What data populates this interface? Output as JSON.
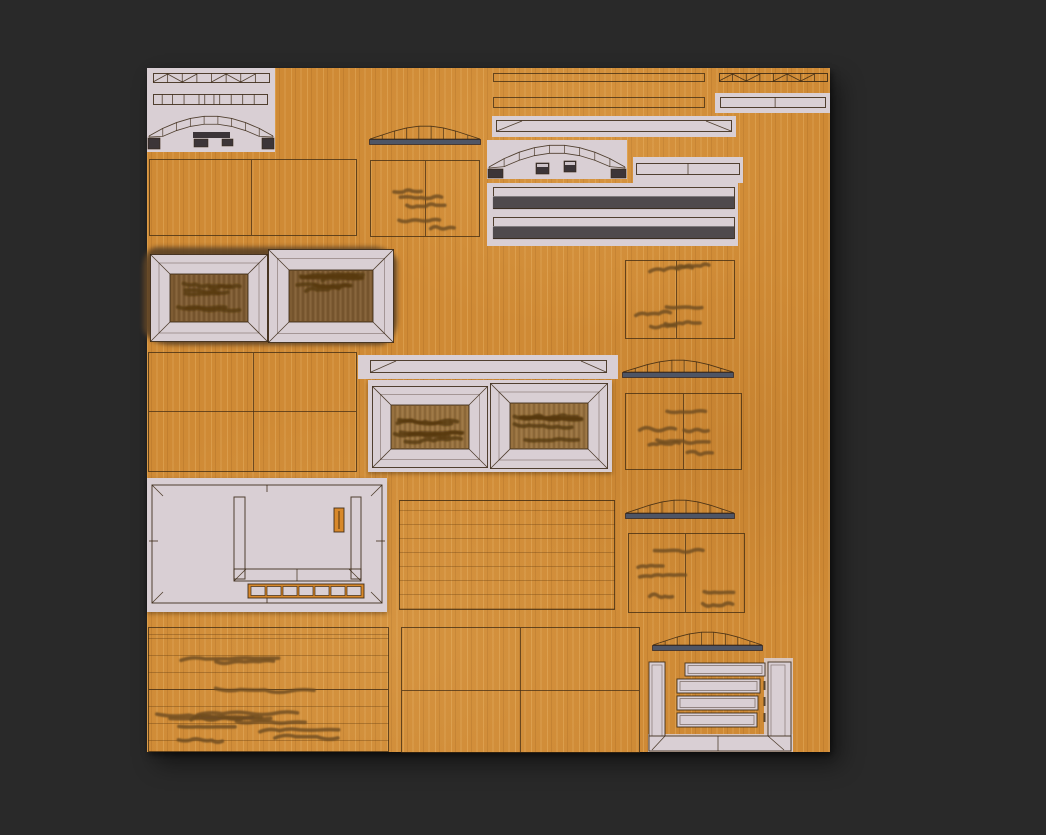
{
  "window": {
    "background": "#292929",
    "content": "wood texture atlas sheet on dark canvas"
  },
  "atlas": {
    "name": "wood-texture-atlas",
    "colors": {
      "bg": "#292929",
      "wood_base": "#cf8a35",
      "panel": "#d9cfd4",
      "outline": "#372612",
      "slat_dark": "#4f4a4d",
      "slate_base": "#4e5565",
      "foot_dark": "#3c3538",
      "blob": "#5d4326",
      "squiggle": "#6f4c20",
      "squiggle_dark": "#58390f",
      "frame_wood_dark": "#7e5c33",
      "frame_wood_mid": "#97713f",
      "accent_orange": "#d8892b"
    },
    "regions": [
      {
        "id": "parts-panel-top-left",
        "kind": "panel with two plank strips and arch wireframe"
      },
      {
        "id": "thin-rail-1",
        "kind": "outlined rail on wood"
      },
      {
        "id": "thin-rail-2",
        "kind": "outlined rail on wood"
      },
      {
        "id": "hatched-strip-top-right",
        "kind": "plank strip wireframe with diagonals"
      },
      {
        "id": "two-cell-strip-panel-top-right",
        "kind": "panel with segmented rail"
      },
      {
        "id": "chamfer-rail-panel",
        "kind": "panel with beveled rail"
      },
      {
        "id": "arch-panel",
        "kind": "panel with segmented arch, feet and corbels"
      },
      {
        "id": "two-cell-strip-panel-mid",
        "kind": "panel with segmented rail"
      },
      {
        "id": "double-dark-rails-panel",
        "kind": "panel with two dark rails"
      },
      {
        "id": "roof-strip-1",
        "kind": "segmented arch roof profile with slate base"
      },
      {
        "id": "grain-cells-1",
        "kind": "two-cell outline with wood grain strokes"
      },
      {
        "id": "plain-cells-1",
        "kind": "two-cell outline"
      },
      {
        "id": "burnt-window-pair",
        "kind": "two framed panels over scorched blob"
      },
      {
        "id": "grain-cells-2",
        "kind": "two-cell outline with wood grain strokes"
      },
      {
        "id": "plain-cells-2",
        "kind": "2x2 outline grid"
      },
      {
        "id": "chamfer-rail-panel-2",
        "kind": "panel with beveled rail"
      },
      {
        "id": "clean-window-pair",
        "kind": "two framed panels on light band"
      },
      {
        "id": "roof-strip-2",
        "kind": "segmented arch roof profile with slate base"
      },
      {
        "id": "grain-cells-3",
        "kind": "two-cell outline with wood grain strokes"
      },
      {
        "id": "door-frame-panel",
        "kind": "large panel with frame wireframe, orange latch slot and segment strip"
      },
      {
        "id": "slatted-rect",
        "kind": "outlined rect with horizontal plank lines"
      },
      {
        "id": "roof-strip-3",
        "kind": "segmented arch roof profile with slate base"
      },
      {
        "id": "grain-cells-4",
        "kind": "two-cell outline with wood grain strokes"
      },
      {
        "id": "grain-planks-bottom-left",
        "kind": "plank rect with heavy grain strokes"
      },
      {
        "id": "plain-cells-3",
        "kind": "2x2 outline grid"
      },
      {
        "id": "roof-strip-4",
        "kind": "segmented arch roof profile with slate base"
      },
      {
        "id": "shutter-frame",
        "kind": "U channel frame with four slats"
      }
    ]
  }
}
